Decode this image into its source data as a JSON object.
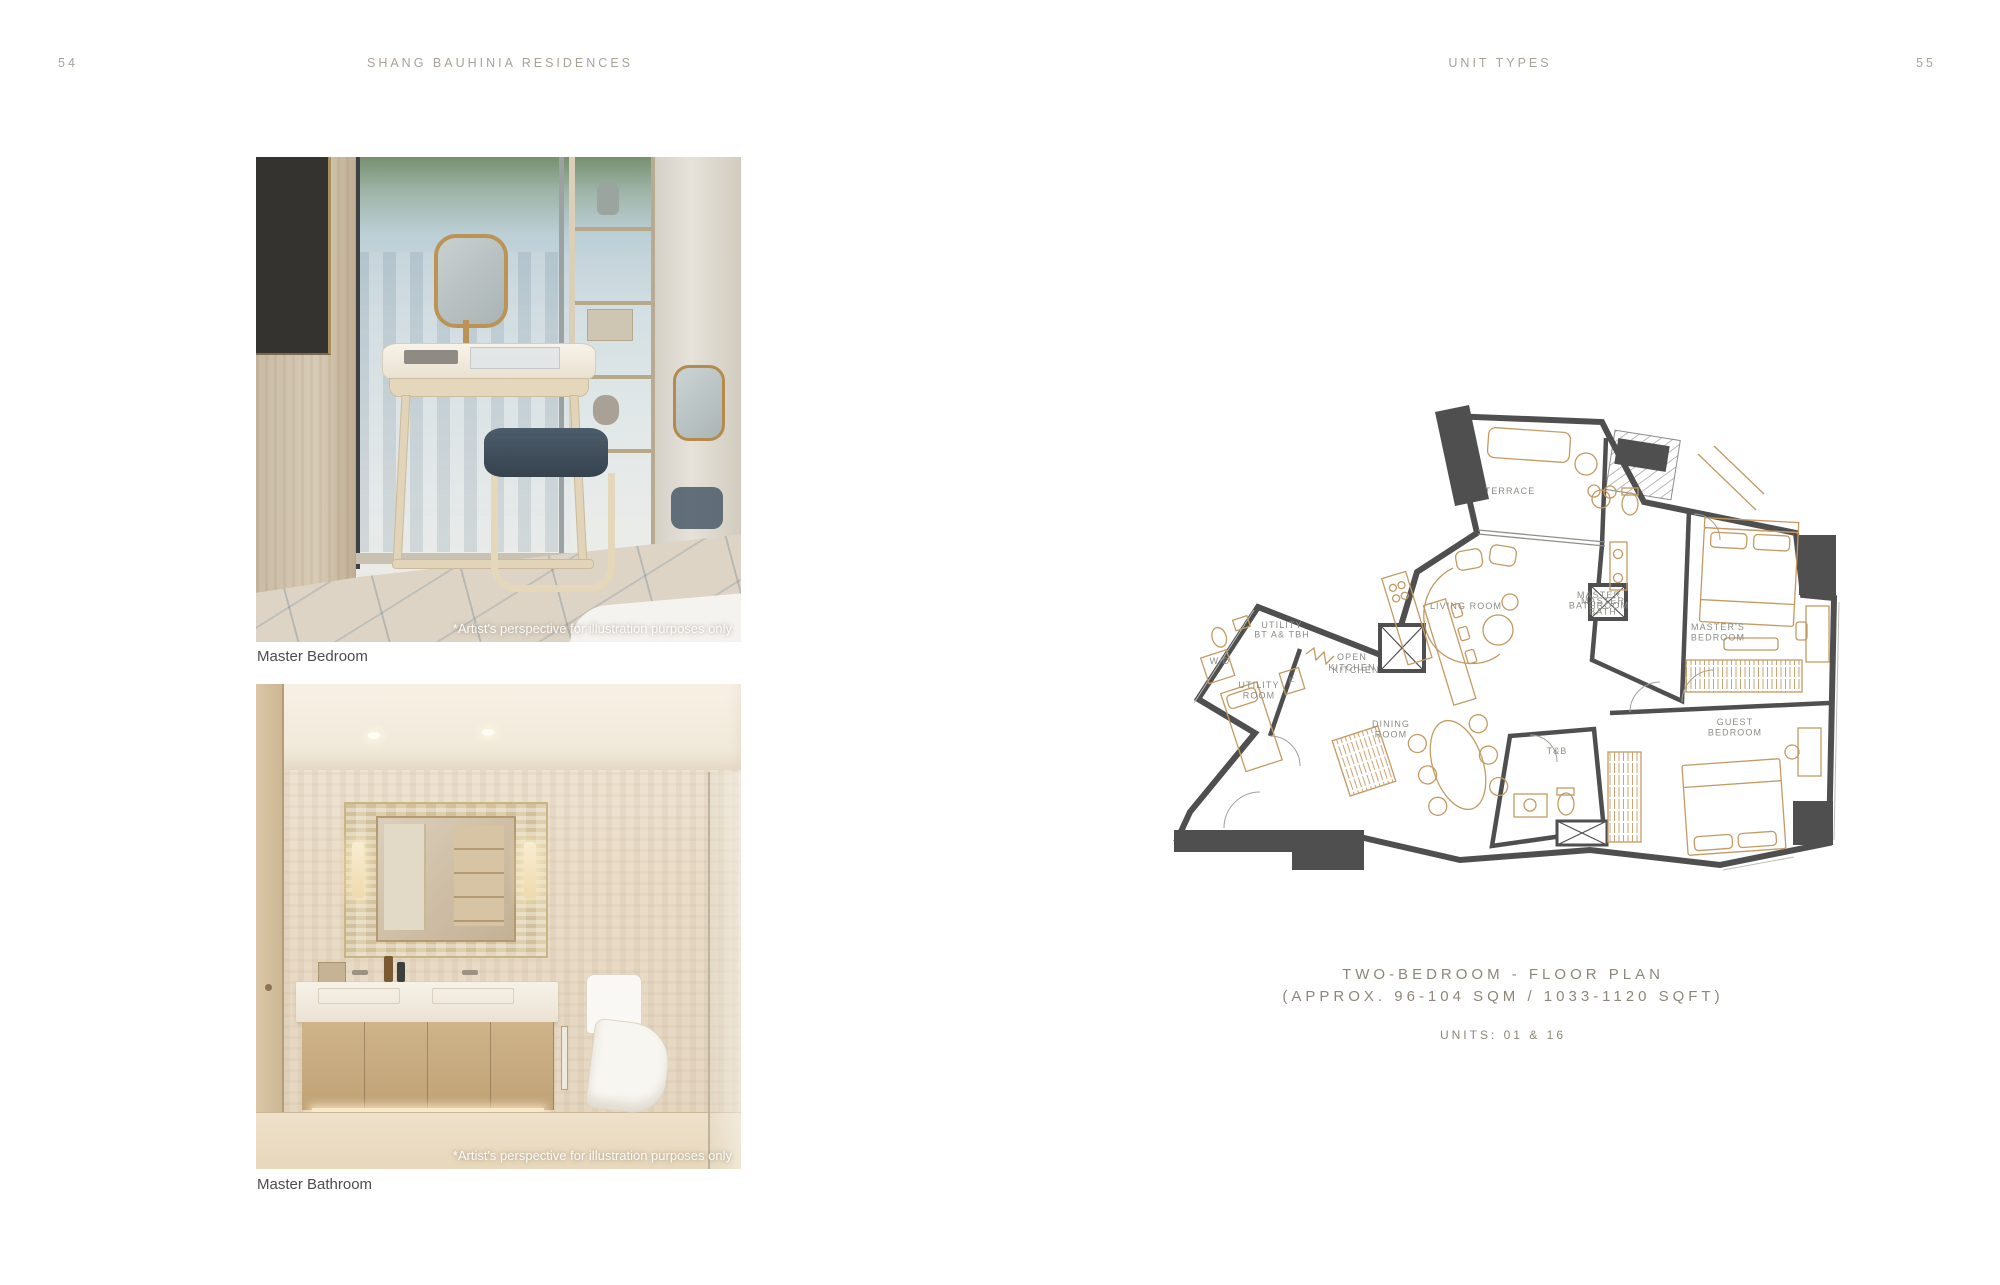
{
  "header": {
    "left_page_number": "54",
    "left_title": "SHANG BAUHINIA RESIDENCES",
    "right_title": "UNIT TYPES",
    "right_page_number": "55"
  },
  "photos": [
    {
      "caption": "Master Bedroom",
      "disclaimer": "*Artist's perspective for illustration purposes only"
    },
    {
      "caption": "Master Bathroom",
      "disclaimer": "*Artist's perspective for illustration purposes only"
    }
  ],
  "floor_plan": {
    "title_line1": "TWO-BEDROOM - FLOOR PLAN",
    "title_line2": "(APPROX. 96-104 SQM / 1033-1120 SQFT)",
    "units": "UNITS: 01 & 16",
    "palette": {
      "wall": "#4f4f4f",
      "furniture": "#c49a62",
      "label": "#8c8c86",
      "title_text": "#8d877a",
      "header_text": "#a8a299"
    },
    "room_labels": [
      {
        "lines": [
          "TERRACE"
        ],
        "x": 352,
        "y": 92
      },
      {
        "lines": [
          "LIVING ROOM"
        ],
        "x": 308,
        "y": 207
      },
      {
        "lines": [
          "MASTER",
          "BATHROOM"
        ],
        "x": 441,
        "y": 196
      },
      {
        "lines": [
          "MASTER",
          "BATH"
        ],
        "x": 445,
        "y": 202
      },
      {
        "lines": [
          "MASTER'S",
          "BEDROOM"
        ],
        "x": 560,
        "y": 228
      },
      {
        "lines": [
          "W/D"
        ],
        "x": 62,
        "y": 262,
        "size": 6.5
      },
      {
        "lines": [
          "UTILITY",
          "BT A& TBH"
        ],
        "x": 124,
        "y": 226,
        "size": 8
      },
      {
        "lines": [
          "UTILITY",
          "ROOM"
        ],
        "x": 101,
        "y": 286
      },
      {
        "lines": [
          "OPEN",
          "KITCHEN"
        ],
        "x": 194,
        "y": 258
      },
      {
        "lines": [
          "KITCHEN"
        ],
        "x": 198,
        "y": 271
      },
      {
        "lines": [
          "F"
        ],
        "x": 134,
        "y": 282,
        "size": 6.5
      },
      {
        "lines": [
          "DINING",
          "ROOM"
        ],
        "x": 233,
        "y": 325
      },
      {
        "lines": [
          "T&B"
        ],
        "x": 399,
        "y": 352
      },
      {
        "lines": [
          "GUEST",
          "BEDROOM"
        ],
        "x": 577,
        "y": 323
      }
    ]
  }
}
